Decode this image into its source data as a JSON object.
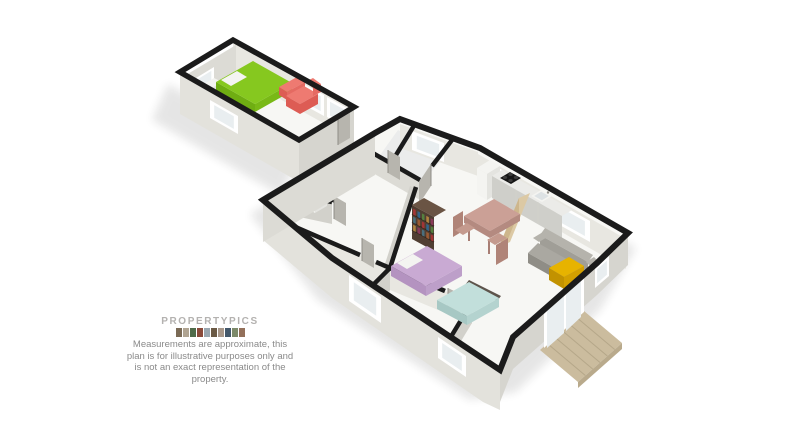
{
  "branding": {
    "logo_text": "PROPERTYPICS"
  },
  "disclaimer": {
    "text": "Measurements are approximate, this plan is for illustrative purposes only and is not an exact representation of the property."
  },
  "floorplan": {
    "view": "3d-isometric-dollhouse",
    "buildings": [
      {
        "name": "annexe",
        "rooms": [
          {
            "name": "studio-room",
            "furniture": [
              "double-bed-green",
              "sofa-red",
              "nightstand",
              "tv"
            ],
            "features": [
              "windows",
              "radiator",
              "entrance-door"
            ]
          }
        ]
      },
      {
        "name": "main-house",
        "rooms": [
          {
            "name": "utility-room",
            "furniture": [
              "washing-machine"
            ]
          },
          {
            "name": "bathroom",
            "furniture": []
          },
          {
            "name": "hallway",
            "furniture": []
          },
          {
            "name": "kitchen-diner",
            "furniture": [
              "kitchen-counter",
              "hob",
              "sink",
              "tall-unit",
              "breakfast-bar",
              "dining-table",
              "chairs",
              "bookshelf"
            ]
          },
          {
            "name": "living-area",
            "furniture": [
              "sofa-gray",
              "coffee-table-yellow"
            ]
          },
          {
            "name": "bedroom-1",
            "furniture": [
              "double-bed-purple"
            ]
          },
          {
            "name": "bedroom-2",
            "furniture": [
              "double-bed-teal"
            ]
          }
        ],
        "features": [
          "sliding-patio-doors",
          "timber-decking"
        ]
      }
    ]
  },
  "colors": {
    "wallTop": "#1b1b1b",
    "wallExt": "#e3e2dc",
    "wallExtDark": "#d6d5cf",
    "wallInt": "#e8e7e1",
    "wallInt2": "#dcdbd5",
    "wallMid": "#d2d1cb",
    "floor": "#f7f7f4",
    "floorTint": "#ebecec",
    "glass": "#e9eef0",
    "frame": "#ffffff",
    "door": "#b7b5ae",
    "doorEdge": "#8f8d87",
    "bedGreen": "#86c81f",
    "bedGreenMid": "#79b916",
    "bedGreenDark": "#6fae12",
    "sofaRed": "#ee7a71",
    "sofaRedMid": "#e56a62",
    "sofaRedDark": "#dd5c54",
    "purple": "#c9aad3",
    "purpleMid": "#bd9fc9",
    "purpleDark": "#b493c0",
    "teal": "#c2dfdb",
    "tealMid": "#b4d3cf",
    "tealDark": "#a7c8c4",
    "headboard": "#5d544b",
    "yellow": "#e7b300",
    "yellowMid": "#d3a000",
    "yellowDark": "#c29200",
    "sofaGrayLight": "#b5b3ac",
    "sofaGray": "#a09e97",
    "sofaGraySeat": "#aaa8a1",
    "sofaGrayDark": "#8f8d86",
    "tableTop": "#cba096",
    "tableSide": "#b48a80",
    "tableLeg": "#a87e74",
    "chair": "#c49a8e",
    "chairDark": "#b08478",
    "shelfTop": "#6a5444",
    "shelfFace": "#503e32",
    "shelfLine": "#33271e",
    "counterTop": "#ebebe8",
    "counterFace": "#cfcfca",
    "hob": "#161616",
    "burner": "#3c3c3c",
    "sinkInner": "#dde2e4",
    "barTop": "#dcc9a4",
    "barFace": "#cdb68c",
    "white": "#f4f4f1",
    "whiteSide": "#e4e4e0",
    "deck": "#cbbc9e",
    "deckLine": "#b5a789",
    "deckSide": "#b9aa8c",
    "tv": "#2a2a2a",
    "shadow": "#222222",
    "books": [
      "#a23535",
      "#33658a",
      "#55803f",
      "#b08440",
      "#8a3a5a",
      "#4a6f7d",
      "#9a5a33"
    ]
  },
  "photo_strip_colors": [
    "#7a6a55",
    "#b0a492",
    "#4f6b4a",
    "#8a4a3a",
    "#9aa7b0",
    "#6b5a45",
    "#a8988a",
    "#43586b",
    "#7d8a6a",
    "#93705a"
  ]
}
